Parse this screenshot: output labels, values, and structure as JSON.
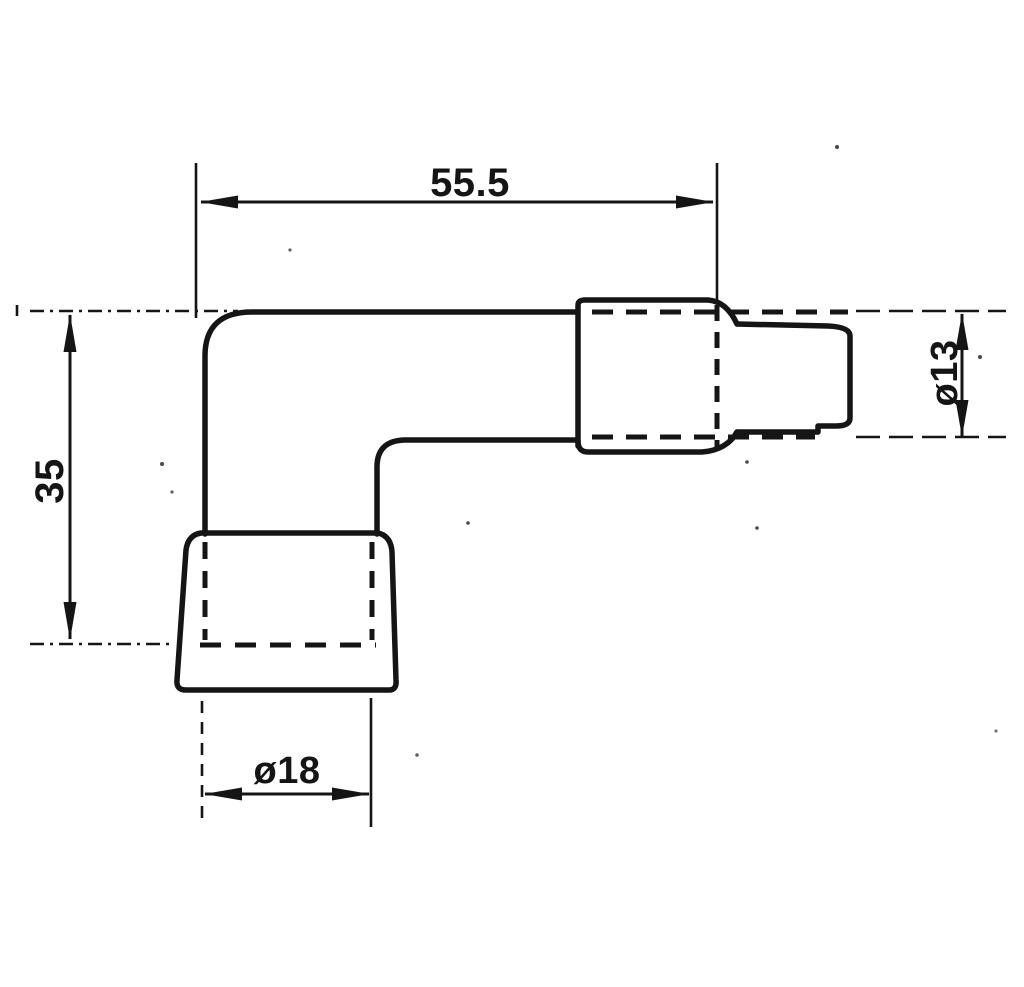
{
  "figure": {
    "background_color": "#ffffff",
    "line_color": "#151515",
    "dimensions": {
      "width_top": {
        "label": "55.5"
      },
      "height_left": {
        "label": "35"
      },
      "diameter_right": {
        "label": "ø13"
      },
      "diameter_bottom": {
        "label": "ø18"
      }
    }
  }
}
